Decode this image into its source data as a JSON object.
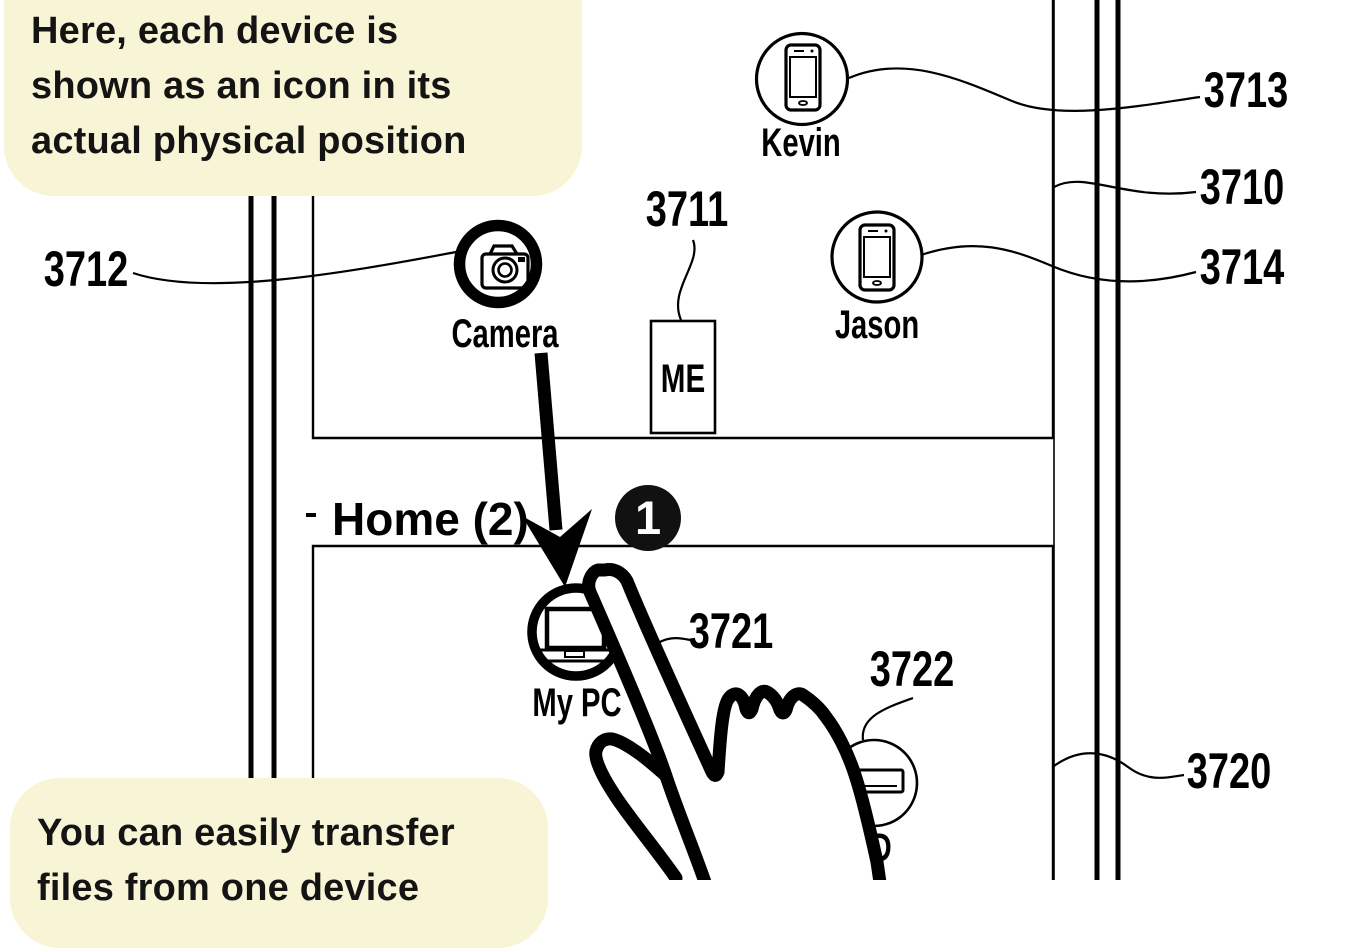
{
  "colors": {
    "note_bg": "#f8f5d6",
    "ink": "#000000",
    "badge_bg": "#111111",
    "badge_fg": "#ffffff"
  },
  "callouts": {
    "top": {
      "lines": [
        "Here, each device is",
        "shown as an icon in its",
        "actual physical position"
      ]
    },
    "bottom": {
      "lines": [
        "You can easily transfer",
        "files from one device"
      ]
    }
  },
  "room1": {
    "devices": {
      "camera": {
        "label": "Camera",
        "icon": "camera-icon"
      },
      "kevin": {
        "label": "Kevin",
        "icon": "smartphone-icon"
      },
      "jason": {
        "label": "Jason",
        "icon": "smartphone-icon"
      },
      "me": {
        "label": "ME",
        "icon": "me-position-box"
      }
    }
  },
  "room2": {
    "title": "Home (2)",
    "badge": "1",
    "devices": {
      "mypc": {
        "label": "My PC",
        "icon": "laptop-icon"
      },
      "storage": {
        "label": "D",
        "icon": "hdd-icon"
      }
    }
  },
  "refs": {
    "3710": "3710",
    "3711": "3711",
    "3712": "3712",
    "3713": "3713",
    "3714": "3714",
    "3720": "3720",
    "3721": "3721",
    "3722": "3722"
  },
  "icons": [
    "camera-icon",
    "smartphone-icon",
    "laptop-icon",
    "hdd-icon",
    "pointing-hand-icon",
    "drag-arrow-icon",
    "step-badge"
  ]
}
